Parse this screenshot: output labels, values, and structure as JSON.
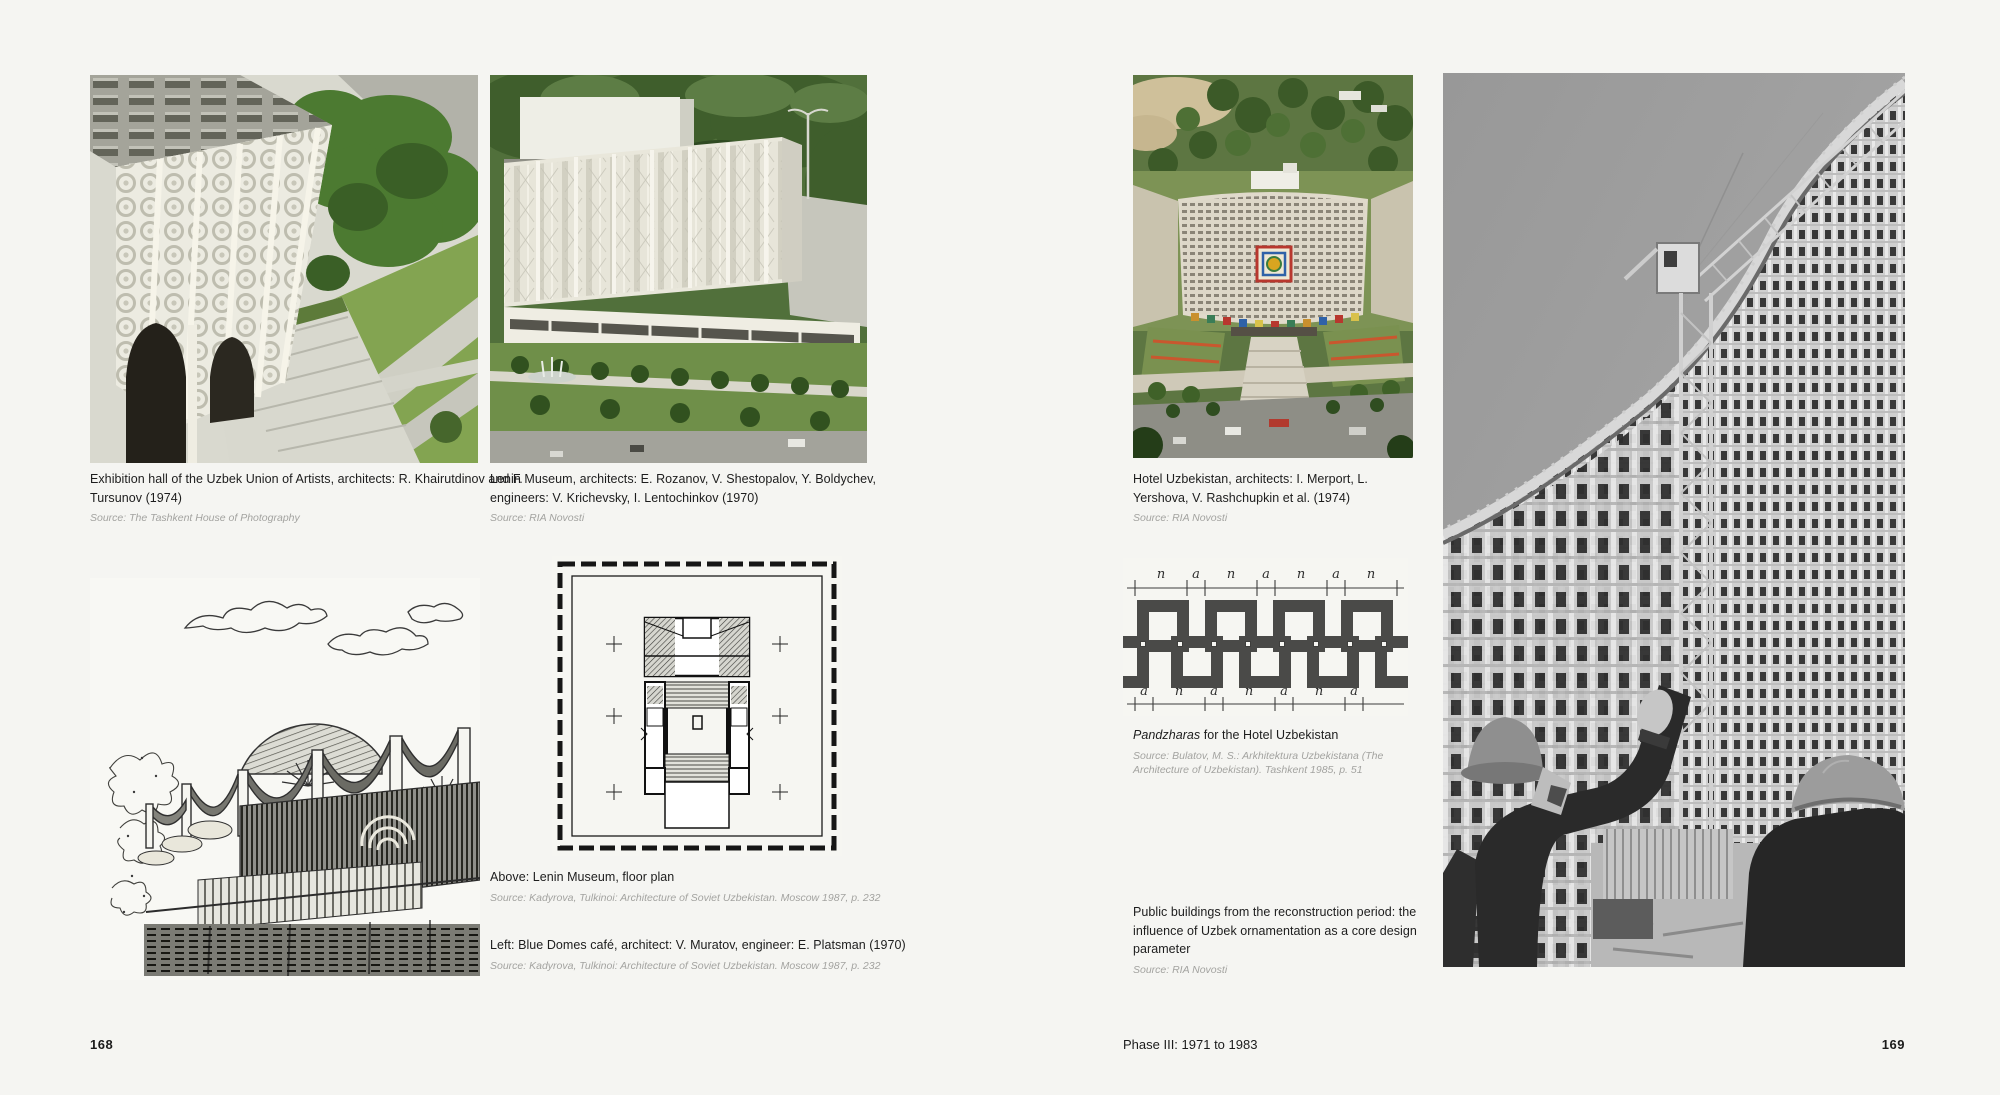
{
  "background": "#f5f5f2",
  "left_page": {
    "page_number": "168",
    "exhibition": {
      "caption": "Exhibition hall of the Uzbek Union of Artists, architects: R. Khairutdinov and F. Tursunov (1974)",
      "source": "Source: The Tashkent House of Photography"
    },
    "lenin_museum": {
      "caption": "Lenin Museum, architects: E. Rozanov, V. Shestopalov, Y. Boldychev, engineers: V. Krichevsky, I. Lentochinkov (1970)",
      "source": "Source: RIA Novosti"
    },
    "floor_plan": {
      "caption": "Above: Lenin Museum, floor plan",
      "source": "Source: Kadyrova, Tulkinoi: Architecture of Soviet Uzbekistan. Moscow 1987, p. 232"
    },
    "blue_domes": {
      "caption": "Left: Blue Domes café, architect: V. Muratov, engineer: E. Platsman (1970)",
      "source": "Source: Kadyrova, Tulkinoi: Architecture of Soviet Uzbekistan. Moscow 1987, p. 232"
    }
  },
  "right_page": {
    "page_number": "169",
    "footer": "Phase III: 1971 to 1983",
    "hotel": {
      "caption": "Hotel Uzbekistan, architects: I. Merport, L. Yershova, V. Rashchupkin et al. (1974)",
      "source": "Source: RIA Novosti"
    },
    "pandzharas": {
      "caption_term": "Pandzharas",
      "caption_rest": " for the Hotel Uzbekistan",
      "source": "Source: Bulatov, M. S.: Arkhitektura Uzbekistana (The Architecture of Uzbekistan). Tashkent 1985, p. 51",
      "dim_top": [
        "n",
        "a",
        "n",
        "a",
        "n",
        "a",
        "n"
      ],
      "dim_bottom": [
        "a",
        "n",
        "a",
        "n",
        "a",
        "n",
        "a"
      ]
    },
    "statement": {
      "text": "Public buildings from the reconstruction period: the influence of Uzbek ornamentation as a core design parameter",
      "source": "Source: RIA Novosti"
    }
  }
}
